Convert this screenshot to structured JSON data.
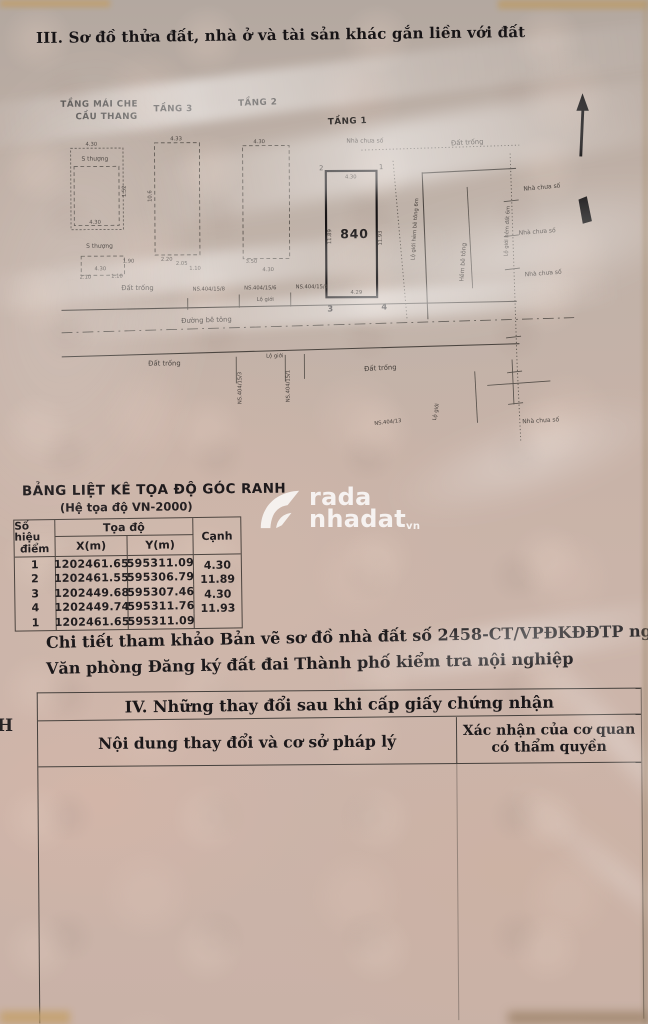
{
  "colors": {
    "paper": "#c9b3a8",
    "ink": "#1c191b"
  },
  "header": {
    "section_title": "III. Sơ đồ thửa đất, nhà ở và tài sản khác gắn liền với đất"
  },
  "diagram": {
    "floors": {
      "roof1": "TẦNG MÁI CHE",
      "roof2": "CẦU THANG",
      "f3": "TẦNG 3",
      "f2": "TẦNG 2",
      "f1": "TẦNG 1"
    },
    "plot": {
      "number": "840",
      "c1": "1",
      "c2": "2",
      "c3": "3",
      "c4": "4"
    },
    "dims": {
      "430": "4.30",
      "433": "4.33",
      "429": "4.29",
      "1189": "11.89",
      "1193": "11.93",
      "106": "10.6",
      "350": "3.50",
      "220": "2.20",
      "205": "2.05",
      "110": "1.10",
      "210": "2.10",
      "190": "1.90",
      "152": "1.52"
    },
    "labels": {
      "s_thuong": "S thượng",
      "dat_trong": "Đất trống",
      "nha_chua_so": "Nhà chưa số",
      "lo_gioi": "Lộ giới",
      "duong_be_tong": "Đường bê tông",
      "hem_be_tong": "Hẻm bê tông",
      "lo_gioi_hem_bt": "Lộ giới hẻm bê tông 6m",
      "lo_gioi_hem_dat": "Lộ giới hẻm đất 6m",
      "ns_404_15_8": "NS.404/15/8",
      "ns_404_15_6": "NS.404/15/6",
      "ns_404_15_4": "NS.404/15/4",
      "ns_404_15_3": "NS.404/15/3",
      "ns_404_15_1": "NS.404/15/1",
      "ns_404_13": "NS.404/13"
    }
  },
  "coord_table": {
    "title": "BẢNG LIỆT KÊ TỌA ĐỘ GÓC RANH",
    "subtitle": "(Hệ tọa độ VN-2000)",
    "col_point_1": "Số hiệu",
    "col_point_2": "điểm",
    "col_coords": "Tọa độ",
    "col_x": "X(m)",
    "col_y": "Y(m)",
    "col_edge": "Cạnh",
    "rows": [
      {
        "point": "1",
        "x": "1202461.65",
        "y": "595311.09"
      },
      {
        "point": "2",
        "x": "1202461.55",
        "y": "595306.79"
      },
      {
        "point": "3",
        "x": "1202449.68",
        "y": "595307.46"
      },
      {
        "point": "4",
        "x": "1202449.74",
        "y": "595311.76"
      },
      {
        "point": "1",
        "x": "1202461.65",
        "y": "595311.09"
      }
    ],
    "edges": [
      "4.30",
      "11.89",
      "4.30",
      "11.93"
    ]
  },
  "notes": {
    "line1": "Chi tiết tham khảo Bản vẽ sơ đồ nhà đất số 2458-CT/VPĐKĐĐTP ngày 21/11/2018 do",
    "line2": "Văn phòng Đăng ký đất đai Thành phố kiểm tra nội nghiệp"
  },
  "section4": {
    "title": "IV. Những thay đổi sau khi cấp giấy chứng nhận",
    "col_content": "Nội dung thay đổi và cơ sở pháp lý",
    "col_confirm_1": "Xác nhận của cơ quan",
    "col_confirm_2": "có thẩm quyền"
  },
  "margin": {
    "left_char": "H"
  },
  "watermark": {
    "top": "rada",
    "bottom": "nhadat",
    "suffix": "vn"
  }
}
